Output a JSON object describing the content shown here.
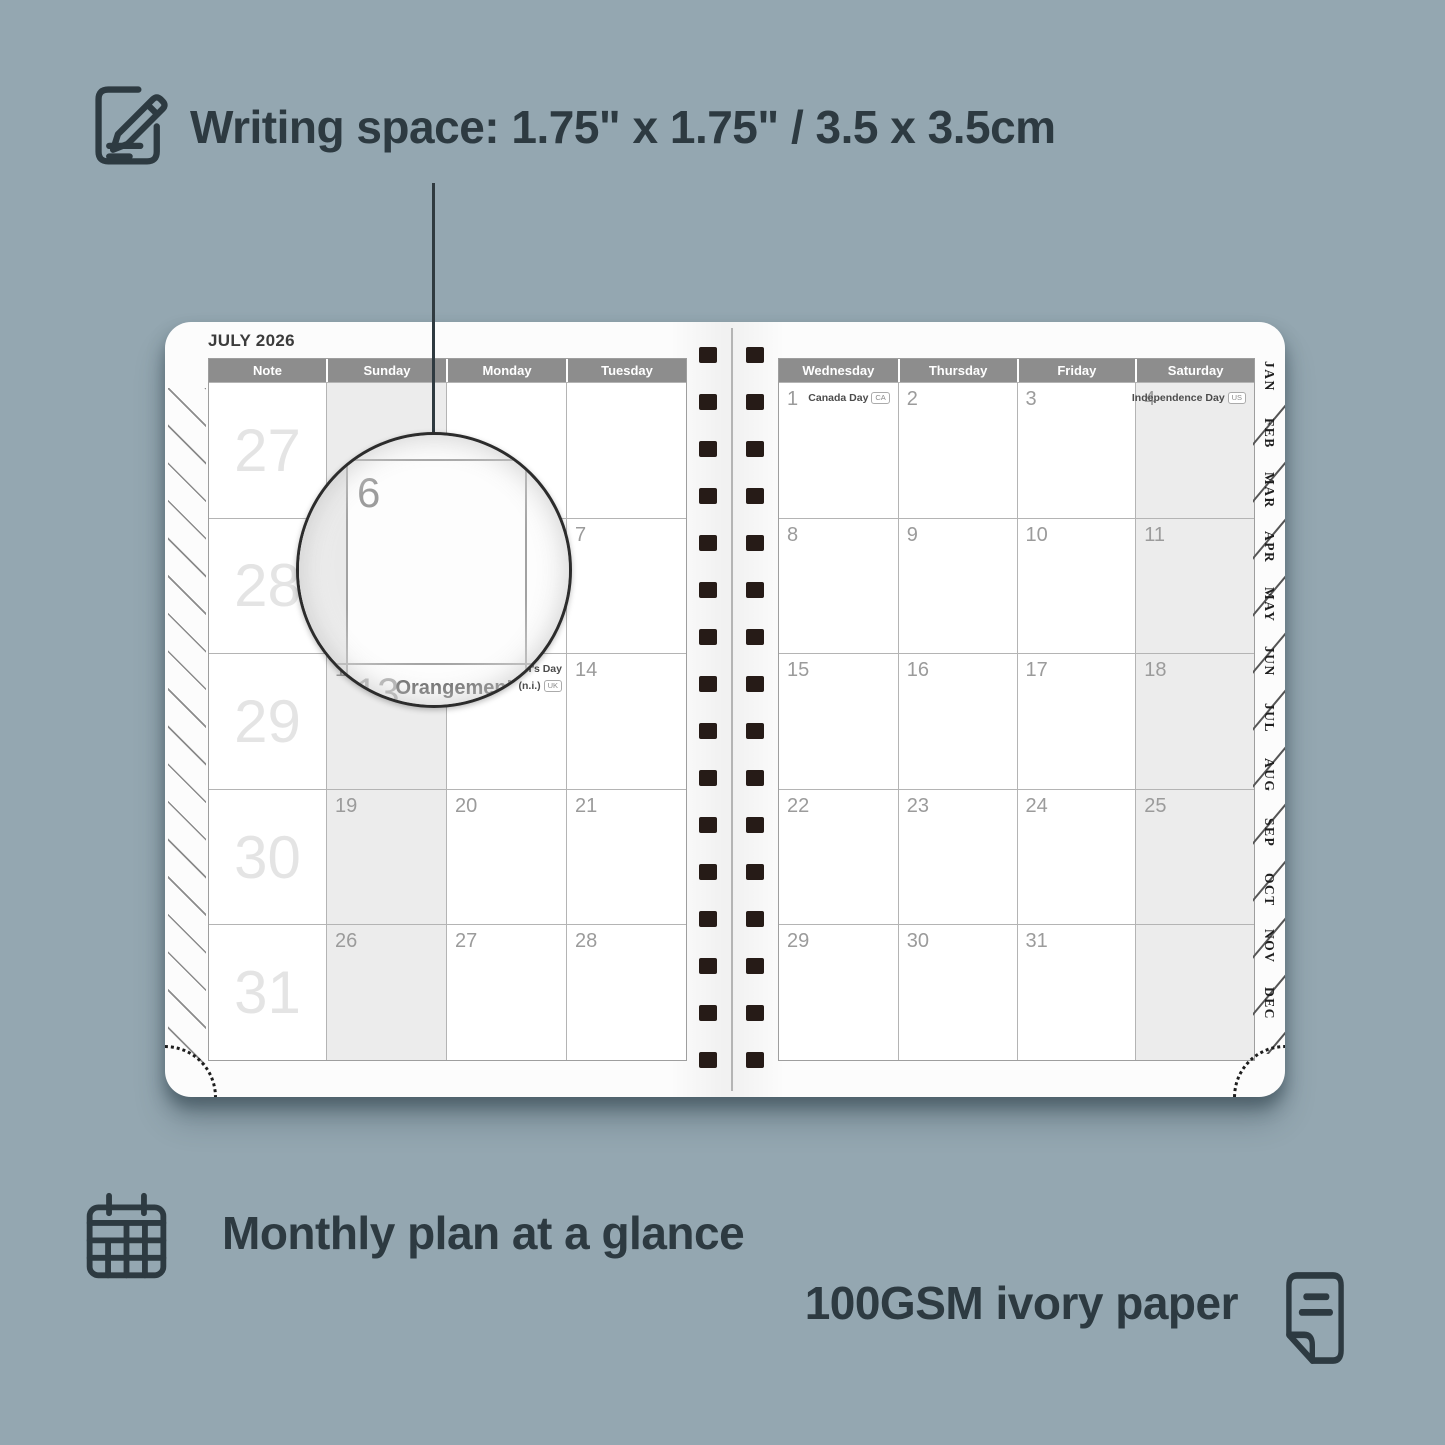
{
  "annotations": {
    "writing_space": "Writing space: 1.75\" x 1.75\" / 3.5 x 3.5cm",
    "monthly_plan": "Monthly plan at a glance",
    "paper": "100GSM ivory paper"
  },
  "colors": {
    "background": "#94a7b1",
    "ink": "#2d3a41",
    "header_bg": "#8d8d8d",
    "weekend_shade": "#ececec",
    "spiral": "#261b17"
  },
  "planner": {
    "month_title": "JULY 2026",
    "left_page": {
      "headers": [
        "Note",
        "Sunday",
        "Monday",
        "Tuesday"
      ],
      "weeks": [
        "27",
        "28",
        "29",
        "30",
        "31"
      ],
      "rows": [
        [
          {
            "d": ""
          },
          {
            "d": ""
          },
          {
            "d": ""
          }
        ],
        [
          {
            "d": "5"
          },
          {
            "d": "6"
          },
          {
            "d": "7"
          }
        ],
        [
          {
            "d": "12"
          },
          {
            "d": "13",
            "h": "Orangemen’s Day (n.i.)",
            "b": "UK"
          },
          {
            "d": "14"
          }
        ],
        [
          {
            "d": "19"
          },
          {
            "d": "20"
          },
          {
            "d": "21"
          }
        ],
        [
          {
            "d": "26"
          },
          {
            "d": "27"
          },
          {
            "d": "28"
          }
        ]
      ]
    },
    "right_page": {
      "headers": [
        "Wednesday",
        "Thursday",
        "Friday",
        "Saturday"
      ],
      "rows": [
        [
          {
            "d": "1",
            "h": "Canada Day",
            "b": "CA"
          },
          {
            "d": "2"
          },
          {
            "d": "3"
          },
          {
            "d": "4",
            "h": "Independence Day",
            "b": "US"
          }
        ],
        [
          {
            "d": "8"
          },
          {
            "d": "9"
          },
          {
            "d": "10"
          },
          {
            "d": "11"
          }
        ],
        [
          {
            "d": "15"
          },
          {
            "d": "16"
          },
          {
            "d": "17"
          },
          {
            "d": "18"
          }
        ],
        [
          {
            "d": "22"
          },
          {
            "d": "23"
          },
          {
            "d": "24"
          },
          {
            "d": "25"
          }
        ],
        [
          {
            "d": "29"
          },
          {
            "d": "30"
          },
          {
            "d": "31"
          },
          {
            "d": ""
          }
        ]
      ]
    },
    "month_tabs": [
      "JAN",
      "FEB",
      "MAR",
      "APR",
      "MAY",
      "JUN",
      "JUL",
      "AUG",
      "SEP",
      "OCT",
      "NOV",
      "DEC"
    ],
    "magnifier": {
      "day": "6",
      "next_day": "13",
      "holiday_line1": "Orangemen’s Day",
      "holiday_line2": "(n.i.)",
      "badge": "UK"
    }
  }
}
